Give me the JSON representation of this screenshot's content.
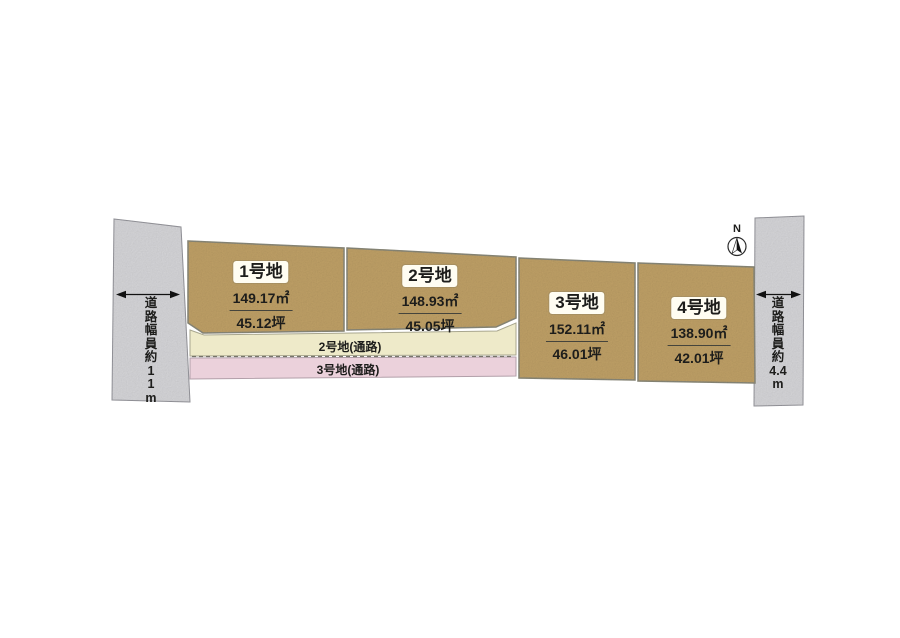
{
  "compass": {
    "north_label": "N"
  },
  "roads": {
    "left": {
      "label": "道路幅員約11m",
      "chars": [
        "道",
        "路",
        "幅",
        "員",
        "約",
        "1",
        "1",
        "m"
      ]
    },
    "right": {
      "label": "道路幅員約4.4m",
      "chars": [
        "道",
        "路",
        "幅",
        "員",
        "約",
        "4.4",
        "m"
      ]
    }
  },
  "plots": [
    {
      "name": "1号地",
      "area_sqm": "149.17㎡",
      "area_tsubo": "45.12坪"
    },
    {
      "name": "2号地",
      "area_sqm": "148.93㎡",
      "area_tsubo": "45.05坪"
    },
    {
      "name": "3号地",
      "area_sqm": "152.11㎡",
      "area_tsubo": "46.01坪"
    },
    {
      "name": "4号地",
      "area_sqm": "138.90㎡",
      "area_tsubo": "42.01坪"
    }
  ],
  "passages": [
    {
      "label": "2号地(通路)"
    },
    {
      "label": "3号地(通路)"
    }
  ],
  "colors": {
    "plot_fill": "#c5a56b",
    "plot_stroke": "#8e8c7c",
    "road_fill": "#dcdcdf",
    "road_stroke": "#9a9aa0",
    "passage2_fill": "#eeeac9",
    "passage2_stroke": "#a8a68e",
    "passage3_fill": "#ebd1db",
    "passage3_stroke": "#b29fa9",
    "dashed_line": "#76746a",
    "arrow": "#111111",
    "text": "#1d1d1b"
  }
}
